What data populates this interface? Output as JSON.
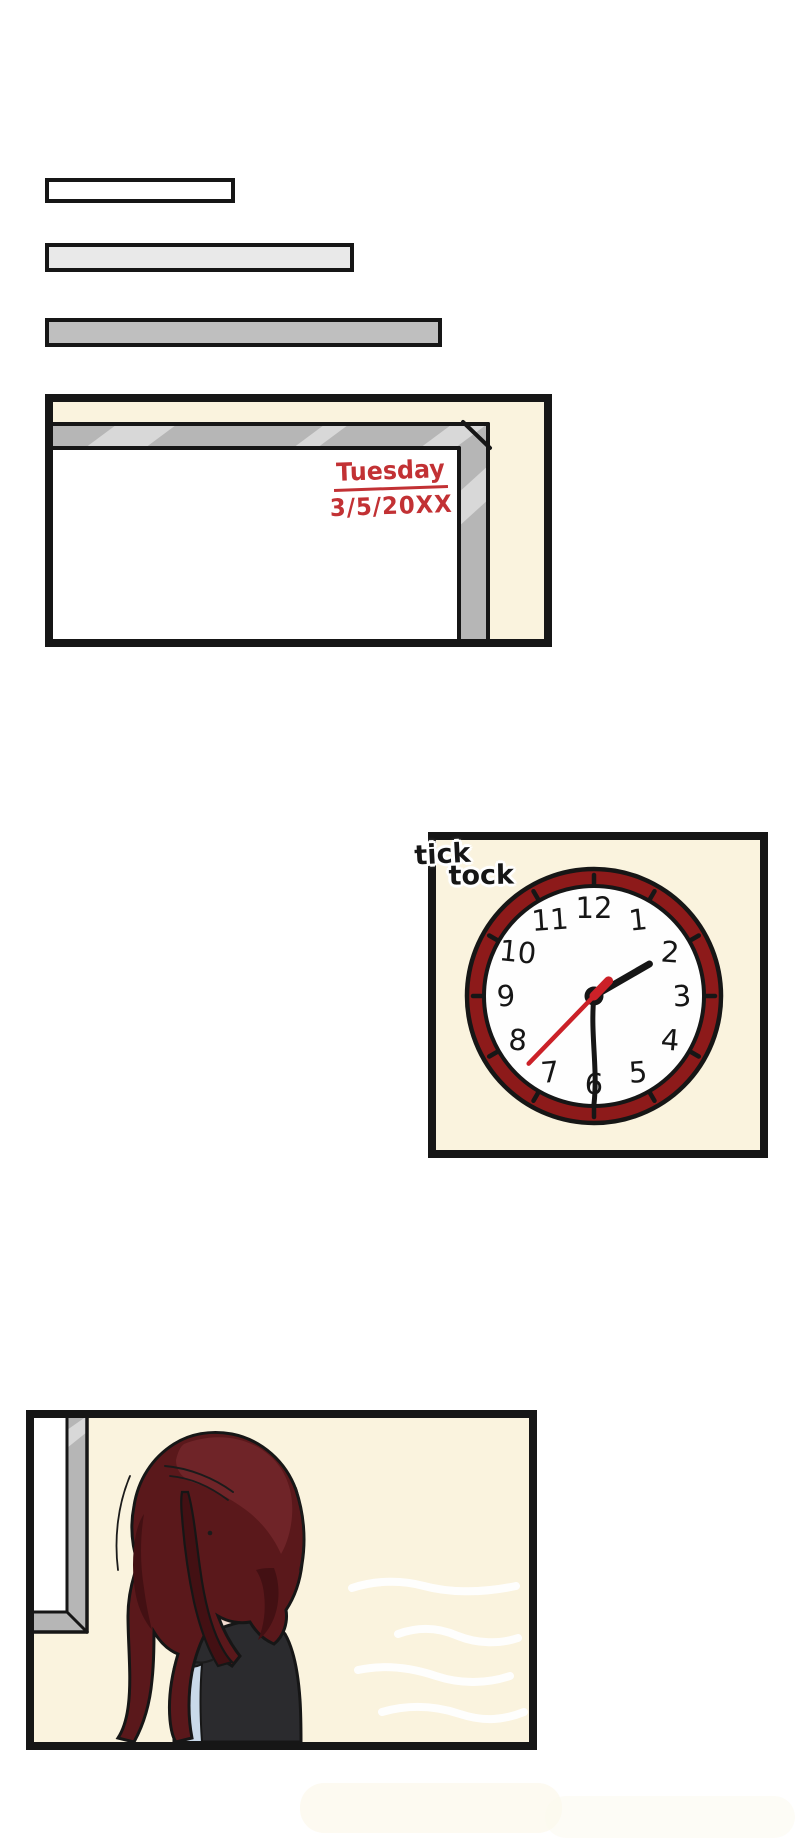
{
  "whiteboard": {
    "day": "Tuesday",
    "date": "3/5/20XX"
  },
  "clock": {
    "sfx": [
      "tick",
      "tock"
    ],
    "numbers": [
      "1",
      "2",
      "3",
      "4",
      "5",
      "6",
      "7",
      "8",
      "9",
      "10",
      "11",
      "12"
    ],
    "hands": {
      "hour_angle_deg": 60,
      "minute_angle_deg": 180,
      "second_angle_deg": 224,
      "second_tail_angle_deg": 44
    }
  },
  "colors": {
    "ink": "#161616",
    "page_bg": "#ffffff",
    "cream": "#faf3de",
    "bar_light": "#e9e9e9",
    "bar_mid": "#bfbfbf",
    "gray_frame": "#b6b6b6",
    "gray_hi": "#d8d8d8",
    "marker_red": "#c23134",
    "clock_ring": "#8d1a1a",
    "clock_face": "#fefefe",
    "hand_red": "#cb2128",
    "skin": "#f3ded2",
    "skin_shade": "#ecc8ba",
    "hair": "#5a181b",
    "hair_dark": "#431013",
    "hair_light": "#6f2428",
    "jacket": "#2b2b2e",
    "shirt": "#c9d9e9"
  }
}
